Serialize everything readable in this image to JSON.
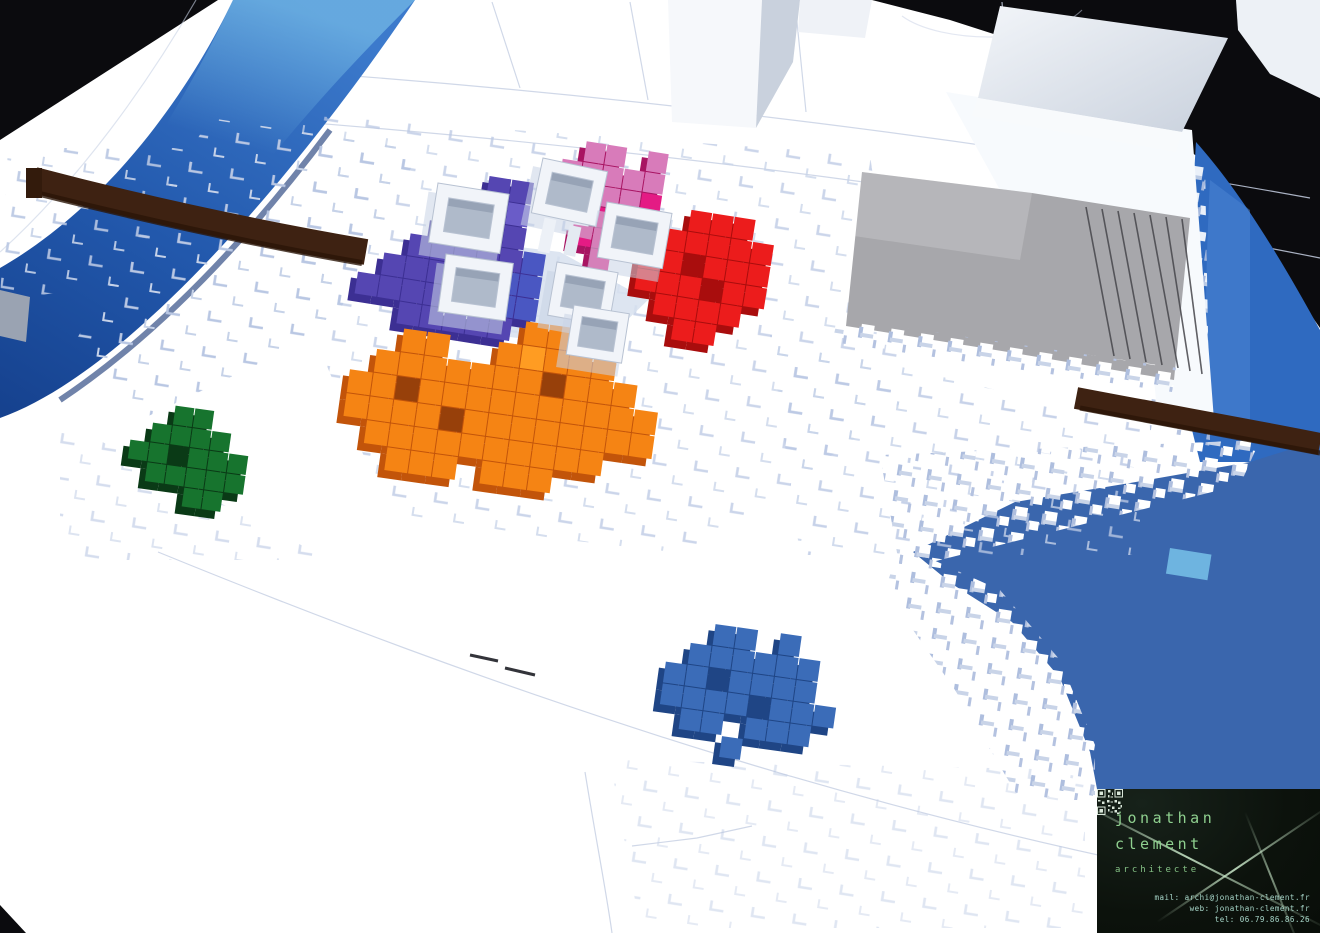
{
  "branding": {
    "name_line1": "jonathan",
    "name_line2": "clement",
    "profession": "architecte",
    "mail": "mail: archi@jonathan-clement.fr",
    "web": "web: jonathan-clement.fr",
    "tel": "tel: 06.79.86.86.26"
  },
  "scene": {
    "type": "3d-voxel-urban-massing-model",
    "clusters": [
      {
        "id": "purple-cluster",
        "color": "#5546B2"
      },
      {
        "id": "pink-cluster",
        "color": "#D87BBA"
      },
      {
        "id": "red-cluster",
        "color": "#EC1C1C"
      },
      {
        "id": "orange-cluster",
        "color": "#F58414"
      },
      {
        "id": "green-cluster",
        "color": "#17742E"
      },
      {
        "id": "blue-cluster",
        "color": "#3B6CB8"
      }
    ]
  },
  "colors": {
    "black": "#0B0B0E",
    "terrain": "#FFFFFF",
    "terrain_shadow": "#B9C7E3",
    "water": "#2F6AC0",
    "water_dark": "#16428F",
    "water_light": "#4E86D4",
    "water_cyan": "#7CC8EC",
    "lake": "#3A66AD",
    "bridge": "#3E2212",
    "bridge_dark": "#2A1508",
    "plaza": "#A7A7AB",
    "plaza_line": "#46464B",
    "dock": "#9AA3B2",
    "building": "#F1F4F9",
    "building_side": "#C6CFDC",
    "building_floor": "#AFBACA",
    "purple": "#5546B2",
    "purple_dark": "#3C2F93",
    "purple_light": "#6A5CC8",
    "purple_blue": "#4A57C2",
    "pink": "#D87BBA",
    "pink_hot": "#E41B84",
    "pink_dark": "#A81462",
    "red": "#EC1C1C",
    "red_dark": "#A90D0D",
    "orange": "#F58414",
    "orange_dark": "#C2540A",
    "orange_deep": "#97400A",
    "orange_light": "#FF9C22",
    "green": "#17742E",
    "green_dark": "#0A3A16",
    "bluec": "#3B6CB8",
    "bluec_dark": "#1F4585",
    "card_bg": "#0D130C",
    "card_text": "#8FD08F",
    "card_sub": "#84C084",
    "card_contact": "#A9D8CB",
    "card_beam": "#CFEFCF"
  }
}
